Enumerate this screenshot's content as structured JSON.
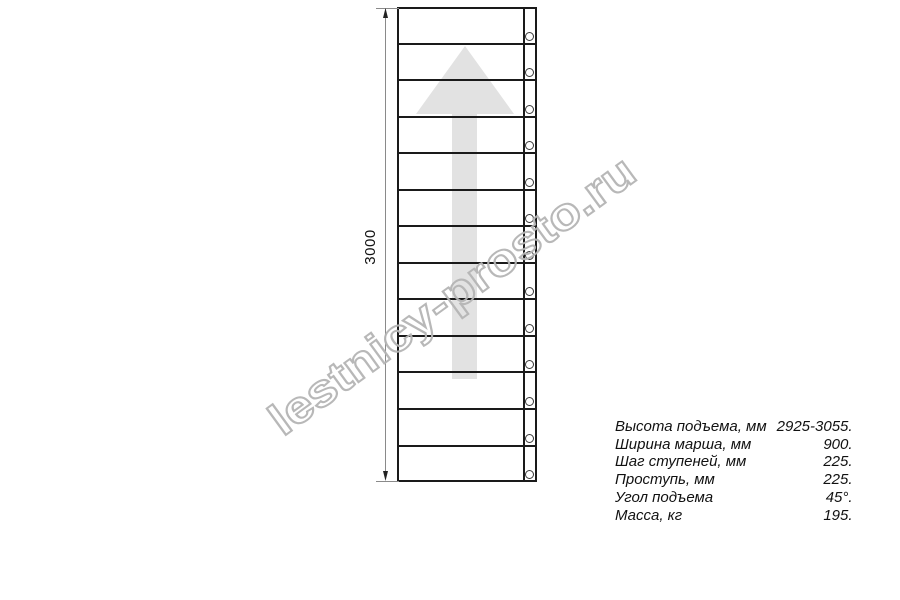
{
  "drawing": {
    "dimension_label": "3000",
    "steps_count": 13,
    "direction_arrow": "up-arrow",
    "colors": {
      "line": "#1a1a1a",
      "arrow_fill": "#e2e2e2",
      "dimension_line": "#8a8a8a",
      "arrowhead": "#222222",
      "watermark_stroke": "#b5b5b5"
    }
  },
  "watermark": {
    "text": "lestnicy-prosto.ru"
  },
  "specs": {
    "rows": [
      {
        "label": "Высота подъема, мм",
        "value": "2925-3055."
      },
      {
        "label": "Ширина марша, мм",
        "value": "900."
      },
      {
        "label": "Шаг ступеней, мм",
        "value": "225."
      },
      {
        "label": "Проступь, мм",
        "value": "225."
      },
      {
        "label": "Угол подъема",
        "value": "45°."
      },
      {
        "label": "Масса, кг",
        "value": "195."
      }
    ]
  }
}
